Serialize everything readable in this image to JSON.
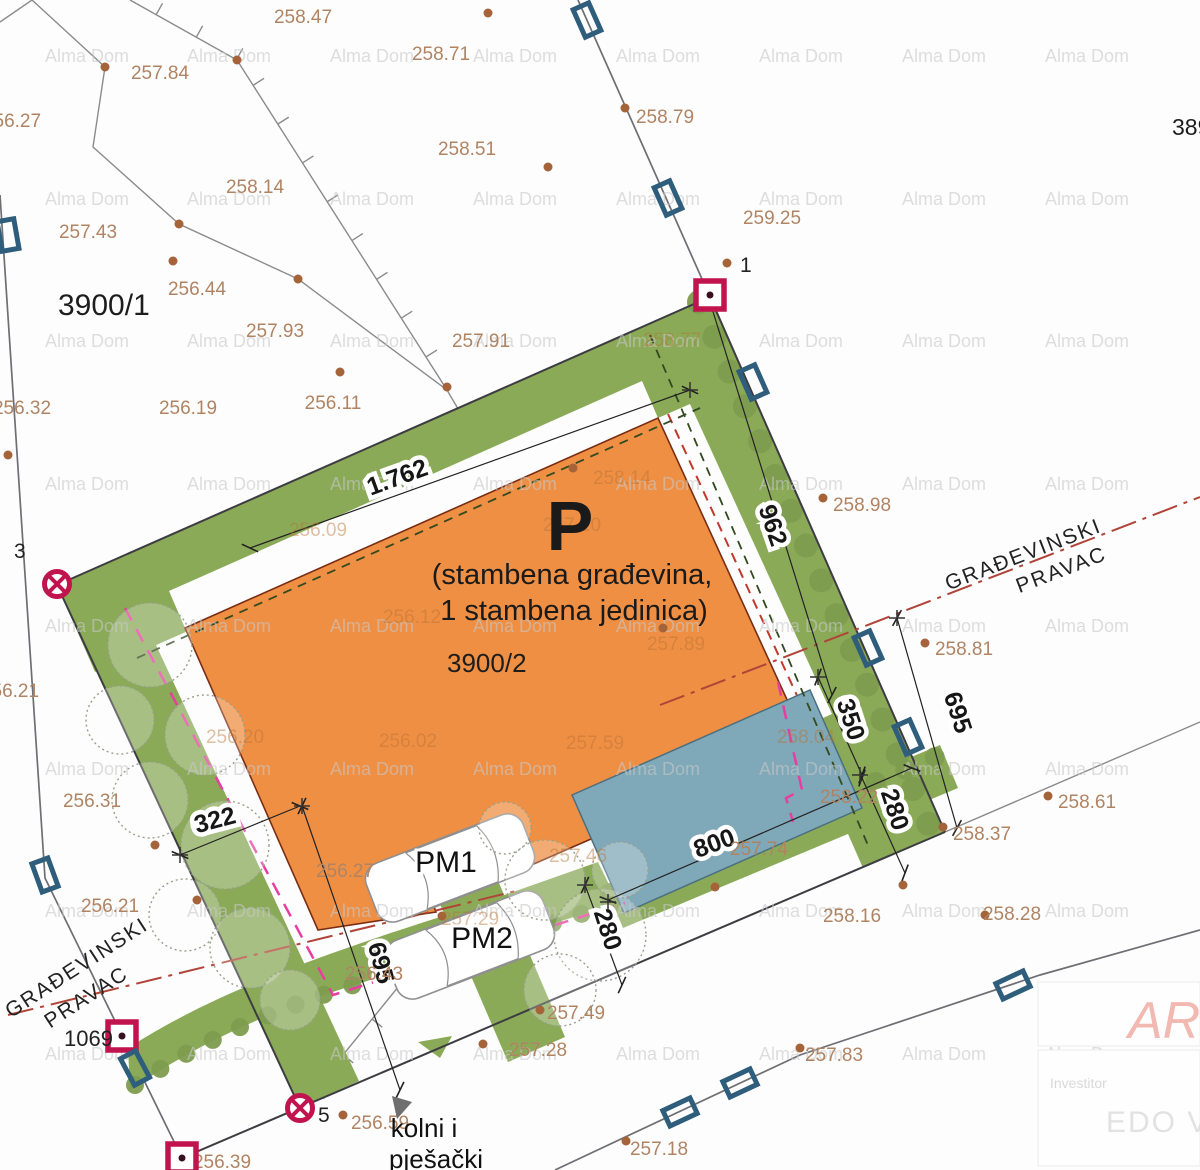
{
  "colors": {
    "building_fill": "#ee8f44",
    "green_area": "#8aaa58",
    "pool_fill": "#7fa8b8",
    "marker_red": "#c1134e",
    "utility_blue": "#2f5d7c",
    "setback_magenta": "#e83ea0",
    "building_line_red": "#b04438",
    "elevation_text": "#b08463"
  },
  "parcels": {
    "main": "3900/2",
    "left": "3900/1",
    "right_edge": "389",
    "road": "1069"
  },
  "building": {
    "mark": "P",
    "line1": "(stambena građevina,",
    "line2": "1 stambena jedinica)"
  },
  "parking": {
    "pm1": "PM1",
    "pm2": "PM2"
  },
  "access": {
    "line1": "kolni i",
    "line2": "pješački"
  },
  "building_line_label": {
    "line1": "GRAĐEVINSKI",
    "line2": "PRAVAC"
  },
  "survey_point_ids": {
    "p1": "1",
    "p3": "3",
    "p5": "5"
  },
  "watermark": {
    "text": "Alma Dom",
    "xs": [
      45,
      187,
      330,
      473,
      616,
      759,
      902,
      1045
    ],
    "ys": [
      62,
      205,
      347,
      490,
      632,
      775,
      917,
      1060
    ]
  },
  "elevations": [
    {
      "t": "258.47",
      "x": 303,
      "y": 23,
      "d": [
        237,
        60
      ]
    },
    {
      "t": "257.84",
      "x": 160,
      "y": 79,
      "d": [
        105,
        67
      ]
    },
    {
      "t": "258.71",
      "x": 441,
      "y": 60,
      "d": [
        488,
        13
      ]
    },
    {
      "t": "256.27",
      "x": 12,
      "y": 127,
      "d": null
    },
    {
      "t": "258.79",
      "x": 665,
      "y": 123,
      "d": [
        625,
        108
      ]
    },
    {
      "t": "258.51",
      "x": 467,
      "y": 155,
      "d": [
        548,
        167
      ]
    },
    {
      "t": "258.14",
      "x": 255,
      "y": 193,
      "d": [
        179,
        224
      ]
    },
    {
      "t": "259.25",
      "x": 772,
      "y": 224,
      "d": null
    },
    {
      "t": "257.43",
      "x": 88,
      "y": 238,
      "d": [
        173,
        261
      ]
    },
    {
      "t": "256.44",
      "x": 197,
      "y": 295,
      "d": [
        298,
        279
      ]
    },
    {
      "t": "257.93",
      "x": 275,
      "y": 337,
      "d": [
        340,
        372
      ]
    },
    {
      "t": "257.91",
      "x": 481,
      "y": 347,
      "d": [
        447,
        387
      ]
    },
    {
      "t": "256.32",
      "x": 22,
      "y": 414,
      "d": [
        8,
        455
      ]
    },
    {
      "t": "256.19",
      "x": 188,
      "y": 414,
      "d": null
    },
    {
      "t": "256.11",
      "x": 333,
      "y": 409,
      "d": null
    },
    {
      "t": "258.98",
      "x": 862,
      "y": 511,
      "d": [
        823,
        498
      ]
    },
    {
      "t": "258.81",
      "x": 964,
      "y": 655,
      "d": [
        925,
        643
      ]
    },
    {
      "t": "256.21",
      "x": 10,
      "y": 697,
      "d": null
    },
    {
      "t": "256.31",
      "x": 92,
      "y": 807,
      "d": [
        155,
        845
      ]
    },
    {
      "t": "258.22",
      "x": 849,
      "y": 803,
      "d": null
    },
    {
      "t": "258.61",
      "x": 1087,
      "y": 808,
      "d": [
        1048,
        796
      ]
    },
    {
      "t": "258.37",
      "x": 982,
      "y": 840,
      "d": [
        943,
        827
      ]
    },
    {
      "t": "257.74",
      "x": 759,
      "y": 855,
      "d": [
        715,
        887
      ]
    },
    {
      "t": "256.27",
      "x": 345,
      "y": 877,
      "d": [
        442,
        916
      ]
    },
    {
      "t": "256.21",
      "x": 110,
      "y": 912,
      "d": [
        197,
        900
      ]
    },
    {
      "t": "258.16",
      "x": 852,
      "y": 922,
      "d": [
        903,
        885
      ]
    },
    {
      "t": "258.28",
      "x": 1012,
      "y": 920,
      "d": [
        985,
        915
      ]
    },
    {
      "t": "256.43",
      "x": 374,
      "y": 980,
      "d": null
    },
    {
      "t": "257.49",
      "x": 576,
      "y": 1019,
      "d": [
        540,
        1010
      ]
    },
    {
      "t": "257.28",
      "x": 538,
      "y": 1056,
      "d": [
        483,
        1044
      ]
    },
    {
      "t": "256.59",
      "x": 380,
      "y": 1129,
      "d": [
        343,
        1115
      ]
    },
    {
      "t": "256.39",
      "x": 222,
      "y": 1168,
      "d": null
    },
    {
      "t": "257.83",
      "x": 834,
      "y": 1061,
      "d": [
        800,
        1048
      ]
    },
    {
      "t": "257.18",
      "x": 659,
      "y": 1155,
      "d": [
        626,
        1141
      ]
    }
  ],
  "elevations_faint": [
    {
      "t": "258.77",
      "x": 672,
      "y": 346,
      "d": null
    },
    {
      "t": "258.14",
      "x": 622,
      "y": 484,
      "d": [
        573,
        468
      ]
    },
    {
      "t": "257.10",
      "x": 572,
      "y": 531,
      "d": null
    },
    {
      "t": "256.09",
      "x": 318,
      "y": 536,
      "d": null
    },
    {
      "t": "256.12",
      "x": 412,
      "y": 623,
      "d": null
    },
    {
      "t": "257.89",
      "x": 676,
      "y": 650,
      "d": [
        663,
        628
      ]
    },
    {
      "t": "256.20",
      "x": 235,
      "y": 743,
      "d": null
    },
    {
      "t": "256.02",
      "x": 408,
      "y": 747,
      "d": null
    },
    {
      "t": "257.59",
      "x": 595,
      "y": 749,
      "d": null
    },
    {
      "t": "258.04",
      "x": 806,
      "y": 743,
      "d": null
    },
    {
      "t": "257.46",
      "x": 578,
      "y": 862,
      "d": null
    },
    {
      "t": "257.29",
      "x": 470,
      "y": 925,
      "d": null
    }
  ],
  "dimensions": [
    {
      "t": "1.762",
      "x": 400,
      "y": 485,
      "r": -20,
      "l": [
        250,
        548,
        690,
        390
      ]
    },
    {
      "t": "962",
      "x": 765,
      "y": 528,
      "r": 71,
      "l": [
        710,
        302,
        832,
        695
      ]
    },
    {
      "t": "322",
      "x": 217,
      "y": 828,
      "r": -15,
      "l": [
        180,
        855,
        300,
        806
      ]
    },
    {
      "t": "695",
      "x": 373,
      "y": 965,
      "r": 75,
      "l": [
        302,
        806,
        400,
        1090
      ]
    },
    {
      "t": "695",
      "x": 950,
      "y": 715,
      "r": 72,
      "l": [
        897,
        618,
        957,
        828
      ]
    },
    {
      "t": "350",
      "x": 843,
      "y": 722,
      "r": 72,
      "l": [
        818,
        677,
        862,
        775
      ]
    },
    {
      "t": "280",
      "x": 887,
      "y": 812,
      "r": 72,
      "l": [
        862,
        778,
        905,
        873
      ]
    },
    {
      "t": "280",
      "x": 600,
      "y": 932,
      "r": 72,
      "l": [
        585,
        885,
        622,
        985
      ]
    },
    {
      "t": "800",
      "x": 717,
      "y": 851,
      "r": -20,
      "l": [
        608,
        900,
        912,
        768
      ]
    }
  ],
  "titleblock": {
    "logo": "ARH",
    "investor_label": "Investitor",
    "investor_name": "EDO VAL"
  }
}
